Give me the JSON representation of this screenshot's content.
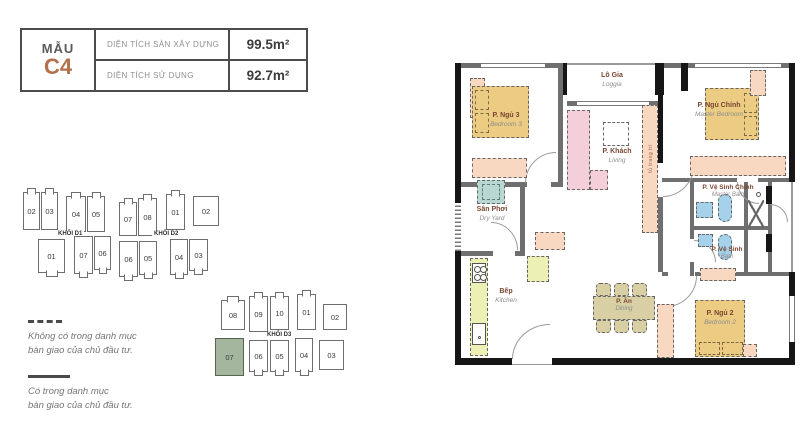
{
  "spec_table": {
    "model_label": "MẪU",
    "model_code": "C4",
    "accent_color": "#b1714b",
    "rows": [
      {
        "label": "DIỆN TÍCH SÀN XÂY DỰNG",
        "value": "99.5m²"
      },
      {
        "label": "DIỆN TÍCH SỬ DỤNG",
        "value": "92.7m²"
      }
    ]
  },
  "block_diagrams": {
    "d1": {
      "label": "KHỐI D1",
      "top_units": [
        "02",
        "03",
        "04",
        "05"
      ],
      "bottom_units": [
        "01",
        "07",
        "06"
      ]
    },
    "d2": {
      "label": "KHỐI D2",
      "top_units": [
        "07",
        "08",
        "01",
        "02"
      ],
      "bottom_units": [
        "06",
        "05",
        "04",
        "03"
      ]
    },
    "d3": {
      "label": "KHỐI D3",
      "top_units": [
        "08",
        "09",
        "10",
        "01",
        "02"
      ],
      "bottom_units": [
        "07",
        "06",
        "05",
        "04",
        "03"
      ],
      "highlighted_unit": "07",
      "highlight_color": "#a4b79e"
    }
  },
  "legend": {
    "not_included": {
      "line1": "Không có trong danh mục",
      "line2": "bàn giao của chủ đầu tư."
    },
    "included": {
      "line1": "Có trong danh mục",
      "line2": "bàn giao của chủ đầu tư."
    }
  },
  "floorplan": {
    "rooms": {
      "bedroom3": {
        "vi": "P. Ngủ 3",
        "en": "Bedroom 3"
      },
      "loggia": {
        "vi": "Lô Gia",
        "en": "Loggia"
      },
      "living": {
        "vi": "P. Khách",
        "en": "Living"
      },
      "master_bedroom": {
        "vi": "P. Ngủ Chính",
        "en": "Master Bedroom"
      },
      "master_bath": {
        "vi": "P. Vệ Sinh Chính",
        "en": "Master Bath"
      },
      "bath": {
        "vi": "P. Vệ Sinh",
        "en": "Bath"
      },
      "dry_yard": {
        "vi": "Sân Phơi",
        "en": "Dry Yard"
      },
      "kitchen": {
        "vi": "Bếp",
        "en": "Kitchen"
      },
      "dining": {
        "vi": "P. Ăn",
        "en": "Dining"
      },
      "bedroom2": {
        "vi": "P. Ngủ 2",
        "en": "Bedroom 2"
      }
    },
    "furniture_labels": {
      "tv_cabinet": "tủ trang trí"
    },
    "colors": {
      "bed": "#eccb82",
      "sofa": "#f4cfd9",
      "cabinet": "#f8d8c0",
      "kitchen_counter": "#edf0b5",
      "bath_fixture": "#a5d1ea",
      "dining_set": "#d8cfa4",
      "washer": "#b9d7d2",
      "wall_dark": "#161616",
      "wall_gray": "#6f6f6f"
    }
  }
}
